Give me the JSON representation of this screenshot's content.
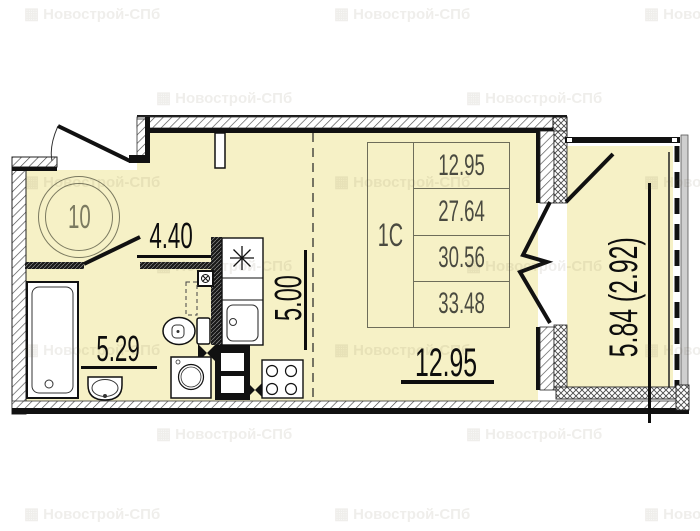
{
  "plan": {
    "unit_circle_number": "10",
    "unit_type_table": {
      "type": "1С",
      "areas": [
        "12.95",
        "27.64",
        "30.56",
        "33.48"
      ]
    },
    "room_dimensions": {
      "hallway": "4.40",
      "bathroom": "5.29",
      "kitchen_zone": "5.00",
      "living_room": "12.95",
      "balcony": "5.84 (2.92)"
    },
    "colors": {
      "floor_fill": "#f6f1c6",
      "wall_line": "#111111",
      "table_line": "#6e6d5a",
      "table_text": "#4a4a40",
      "circle_text": "#7b7a60",
      "dimension_text": "#0d0d0d"
    },
    "watermark": {
      "text": "Новострой-СПб",
      "icon": "▦"
    }
  }
}
